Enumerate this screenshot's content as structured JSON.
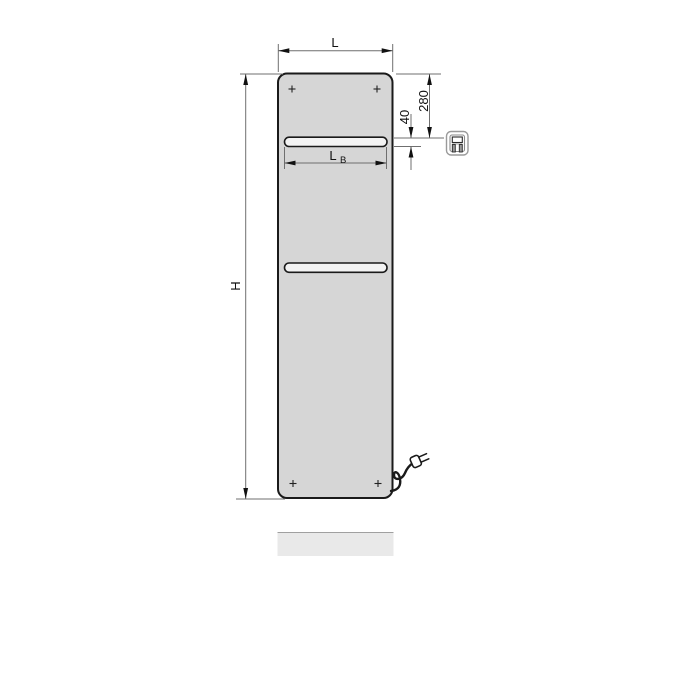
{
  "diagram": {
    "labels": {
      "overall_width": "L",
      "overall_height": "H",
      "rail_width": "L",
      "rail_width_subscript": "B",
      "distance_top_to_rail_mm": "280",
      "rail_height_mm": "40"
    },
    "colors": {
      "background": "#ffffff",
      "panel_fill": "#d6d6d6",
      "panel_outline": "#1a1a1a",
      "rail_fill": "#f3f3f3",
      "dimension_line": "#6f6f6f",
      "dimension_text": "#111111",
      "shadow_fill": "#e9e9e9",
      "shadow_edge": "#a0a0a0"
    },
    "icons": {
      "control_unit": "electric-control-unit-icon",
      "plug": "power-plug-icon"
    }
  }
}
